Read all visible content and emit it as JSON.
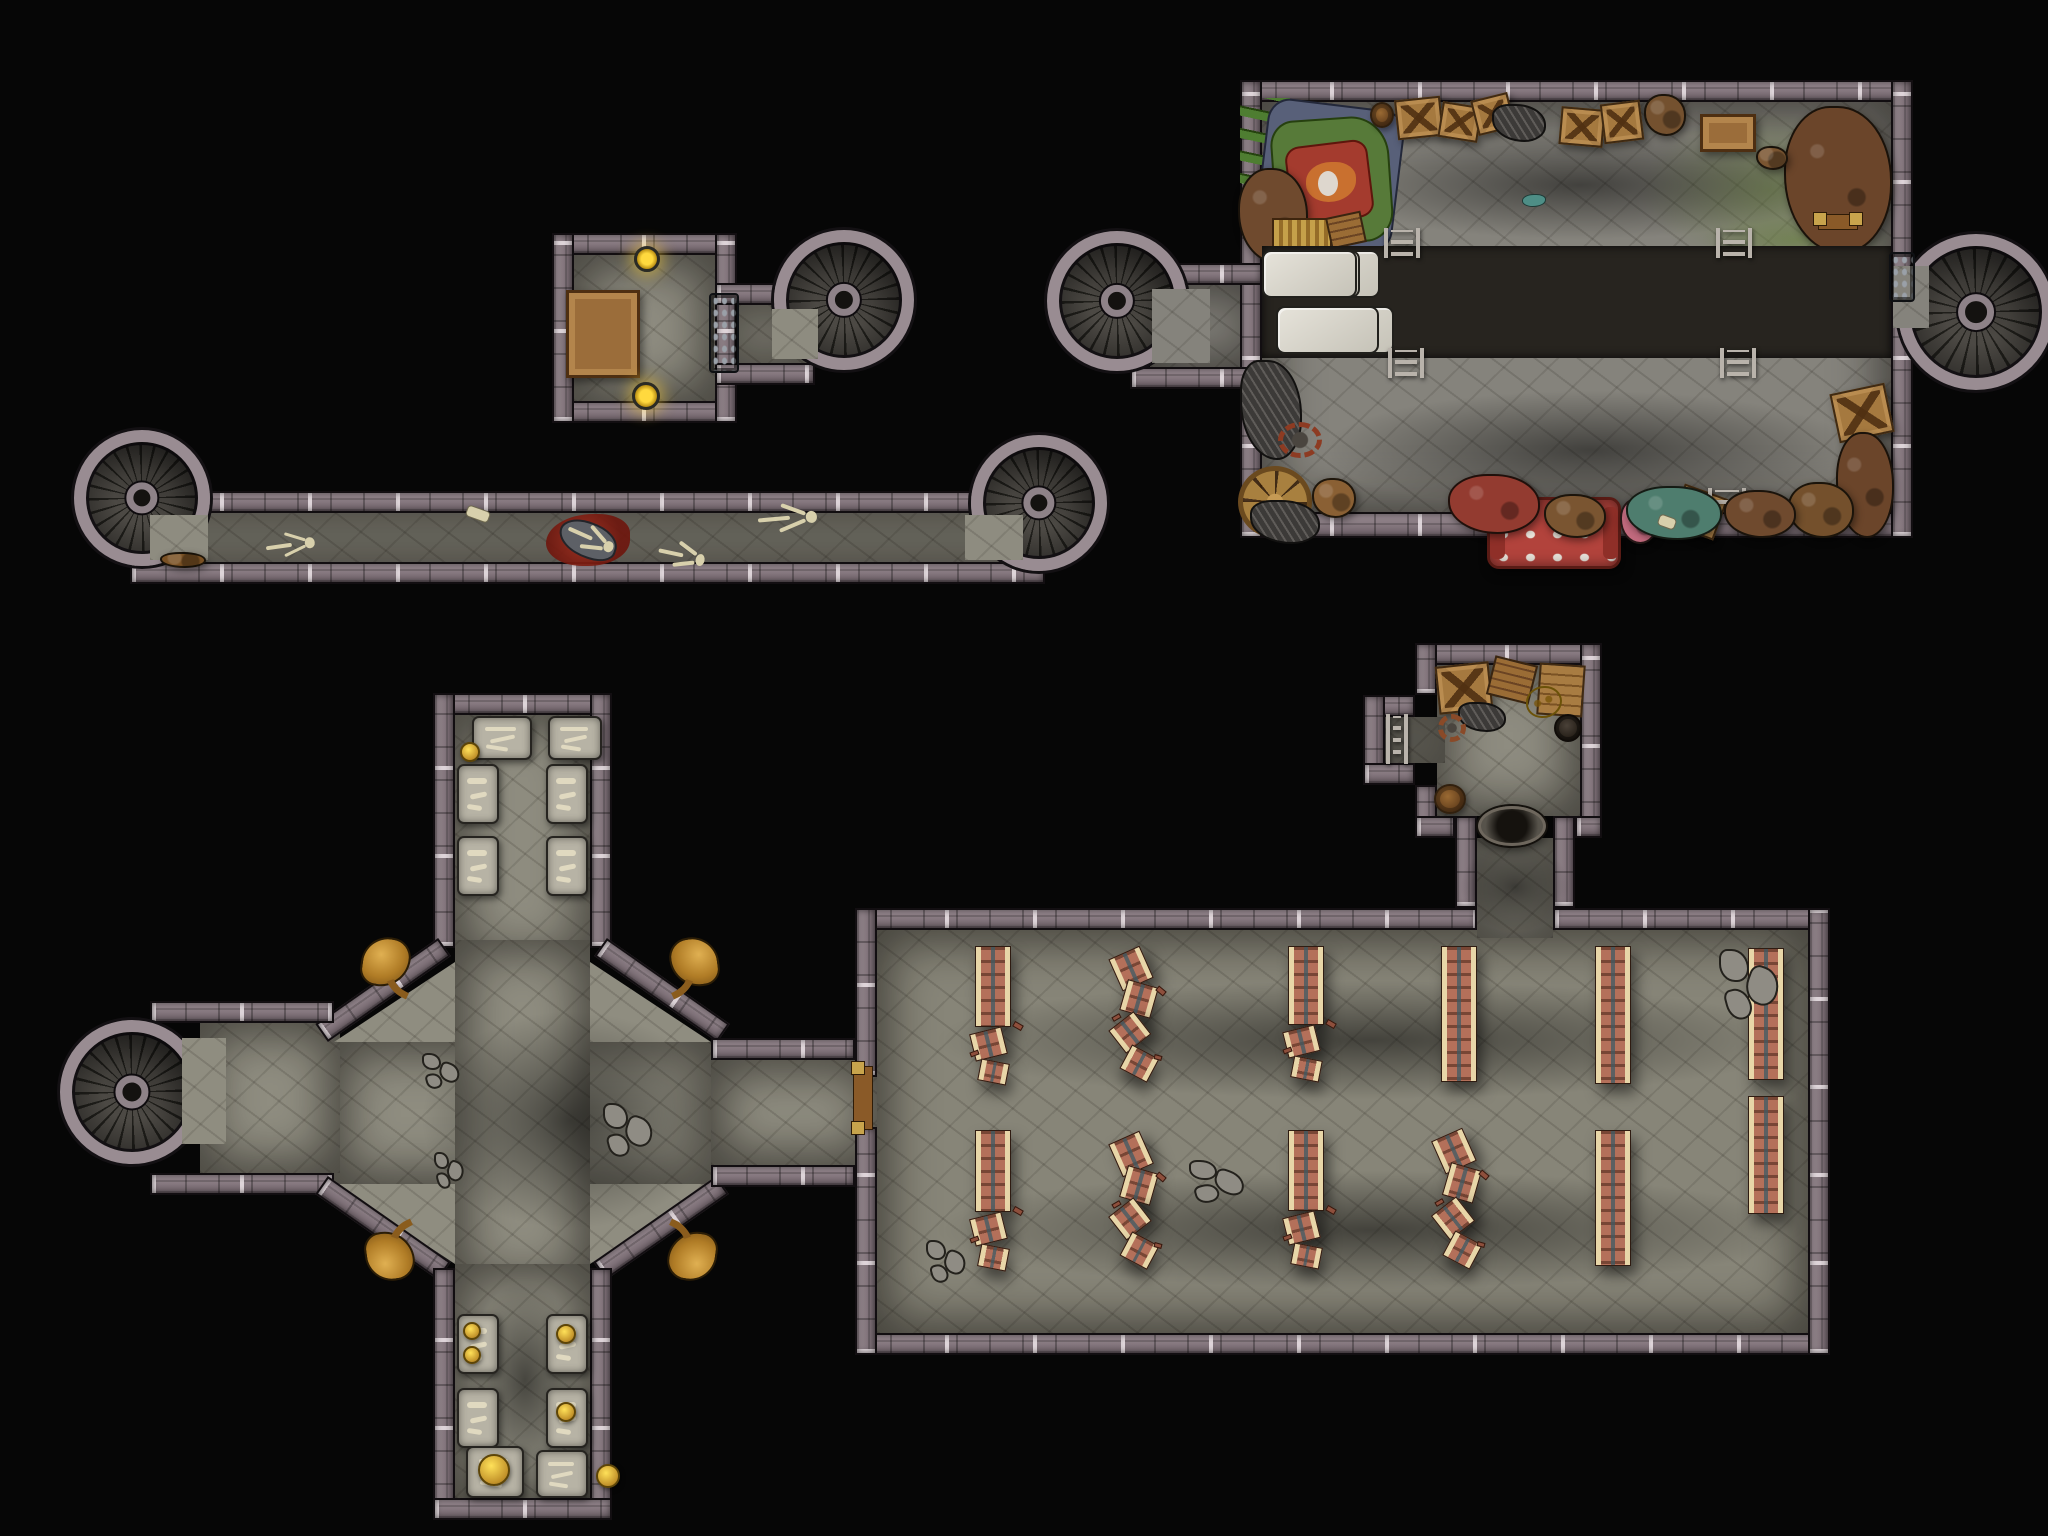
{
  "title": "Top-down dungeon battle map: crypt, chapel hall, storage room and connecting corridors with six spiral staircases",
  "canvas": {
    "w": 2048,
    "h": 1536,
    "bg": "#060606"
  },
  "palette": {
    "background": "#060606",
    "wall": "#80727a",
    "wall_light": "#d6cdd2",
    "wall_dark": "#120e11",
    "floor": "#8e8c80",
    "stair_step": "#4c4944",
    "stair_ring": "#998c92",
    "block_band": "#d6d3c9",
    "bench_wood": "#b4705a",
    "bench_rail": "#e8d6a8",
    "statue_gold": "#c08b33",
    "gold": "#e3c12c",
    "blood": "#8c1f12",
    "rug_green": "#577a39",
    "rug_red": "#a43b2e",
    "moss": "#687f3e",
    "sofa_red": "#b2433c"
  },
  "floors": [
    {
      "x": 574,
      "y": 255,
      "w": 141,
      "h": 146,
      "v": "a"
    },
    {
      "x": 715,
      "y": 305,
      "w": 100,
      "h": 58,
      "v": "a"
    },
    {
      "x": 140,
      "y": 513,
      "w": 905,
      "h": 49,
      "v": "a"
    },
    {
      "x": 1262,
      "y": 102,
      "w": 629,
      "h": 410,
      "v": "b"
    },
    {
      "x": 1150,
      "y": 285,
      "w": 112,
      "h": 82,
      "v": "b"
    },
    {
      "x": 1891,
      "y": 262,
      "w": 40,
      "h": 70,
      "v": "b"
    },
    {
      "x": 455,
      "y": 715,
      "w": 135,
      "h": 250,
      "v": "c"
    },
    {
      "x": 334,
      "y": 1042,
      "w": 377,
      "h": 142,
      "v": "c"
    },
    {
      "x": 455,
      "y": 940,
      "w": 135,
      "h": 350,
      "v": "c"
    },
    {
      "x": 200,
      "y": 1023,
      "w": 140,
      "h": 150,
      "v": "c"
    },
    {
      "x": 711,
      "y": 1060,
      "w": 166,
      "h": 105,
      "v": "c"
    },
    {
      "x": 455,
      "y": 1264,
      "w": 135,
      "h": 234,
      "v": "c"
    },
    {
      "x": 877,
      "y": 930,
      "w": 931,
      "h": 403,
      "v": "d"
    },
    {
      "x": 1437,
      "y": 665,
      "w": 143,
      "h": 151,
      "v": "a"
    },
    {
      "x": 1385,
      "y": 717,
      "w": 60,
      "h": 46,
      "v": "a"
    },
    {
      "x": 1477,
      "y": 838,
      "w": 76,
      "h": 100,
      "v": "a"
    }
  ],
  "floor_polys": [
    {
      "v": "c",
      "points": [
        [
          455,
          962
        ],
        [
          455,
          1042
        ],
        [
          334,
          1042
        ]
      ]
    },
    {
      "v": "c",
      "points": [
        [
          590,
          962
        ],
        [
          711,
          1042
        ],
        [
          590,
          1042
        ]
      ]
    },
    {
      "v": "c",
      "points": [
        [
          334,
          1184
        ],
        [
          455,
          1184
        ],
        [
          455,
          1264
        ]
      ]
    },
    {
      "v": "c",
      "points": [
        [
          711,
          1184
        ],
        [
          590,
          1184
        ],
        [
          590,
          1264
        ]
      ]
    }
  ],
  "walls": [
    {
      "x": 552,
      "y": 233,
      "w": 185,
      "h": 22
    },
    {
      "x": 552,
      "y": 401,
      "w": 185,
      "h": 22
    },
    {
      "x": 552,
      "y": 233,
      "w": 22,
      "h": 190
    },
    {
      "x": 715,
      "y": 233,
      "w": 22,
      "h": 190
    },
    {
      "x": 715,
      "y": 283,
      "w": 100,
      "h": 22
    },
    {
      "x": 715,
      "y": 363,
      "w": 100,
      "h": 22
    },
    {
      "x": 130,
      "y": 491,
      "w": 915,
      "h": 22
    },
    {
      "x": 130,
      "y": 562,
      "w": 915,
      "h": 22
    },
    {
      "x": 1240,
      "y": 80,
      "w": 673,
      "h": 22
    },
    {
      "x": 1240,
      "y": 512,
      "w": 673,
      "h": 26
    },
    {
      "x": 1240,
      "y": 80,
      "w": 22,
      "h": 458
    },
    {
      "x": 1891,
      "y": 80,
      "w": 22,
      "h": 458
    },
    {
      "x": 1130,
      "y": 263,
      "w": 132,
      "h": 22
    },
    {
      "x": 1130,
      "y": 367,
      "w": 132,
      "h": 22
    },
    {
      "x": 433,
      "y": 693,
      "w": 179,
      "h": 22
    },
    {
      "x": 433,
      "y": 693,
      "w": 22,
      "h": 255
    },
    {
      "x": 590,
      "y": 693,
      "w": 22,
      "h": 255
    },
    {
      "x": 308,
      "y": 979,
      "w": 150,
      "h": 22,
      "rot": -35
    },
    {
      "x": 587,
      "y": 979,
      "w": 150,
      "h": 22,
      "rot": 35
    },
    {
      "x": 150,
      "y": 1001,
      "w": 184,
      "h": 22
    },
    {
      "x": 150,
      "y": 1173,
      "w": 184,
      "h": 22
    },
    {
      "x": 308,
      "y": 1217,
      "w": 150,
      "h": 22,
      "rot": 35
    },
    {
      "x": 586,
      "y": 1217,
      "w": 150,
      "h": 22,
      "rot": -35
    },
    {
      "x": 711,
      "y": 1038,
      "w": 144,
      "h": 22
    },
    {
      "x": 711,
      "y": 1165,
      "w": 144,
      "h": 22
    },
    {
      "x": 433,
      "y": 1268,
      "w": 22,
      "h": 252
    },
    {
      "x": 590,
      "y": 1268,
      "w": 22,
      "h": 252
    },
    {
      "x": 433,
      "y": 1498,
      "w": 179,
      "h": 22
    },
    {
      "x": 855,
      "y": 908,
      "w": 622,
      "h": 22
    },
    {
      "x": 1553,
      "y": 908,
      "w": 277,
      "h": 22
    },
    {
      "x": 855,
      "y": 1333,
      "w": 975,
      "h": 22
    },
    {
      "x": 855,
      "y": 908,
      "w": 22,
      "h": 169
    },
    {
      "x": 855,
      "y": 1127,
      "w": 22,
      "h": 228
    },
    {
      "x": 1808,
      "y": 908,
      "w": 22,
      "h": 447
    },
    {
      "x": 1415,
      "y": 643,
      "w": 187,
      "h": 22
    },
    {
      "x": 1415,
      "y": 643,
      "w": 22,
      "h": 52
    },
    {
      "x": 1415,
      "y": 785,
      "w": 22,
      "h": 53
    },
    {
      "x": 1363,
      "y": 695,
      "w": 52,
      "h": 22
    },
    {
      "x": 1363,
      "y": 695,
      "w": 22,
      "h": 90
    },
    {
      "x": 1363,
      "y": 763,
      "w": 52,
      "h": 22
    },
    {
      "x": 1580,
      "y": 643,
      "w": 22,
      "h": 195
    },
    {
      "x": 1415,
      "y": 816,
      "w": 40,
      "h": 22
    },
    {
      "x": 1575,
      "y": 816,
      "w": 27,
      "h": 22
    },
    {
      "x": 1455,
      "y": 816,
      "w": 22,
      "h": 92
    },
    {
      "x": 1553,
      "y": 816,
      "w": 22,
      "h": 92
    }
  ],
  "stairs": [
    {
      "name": "nw-room-stair",
      "cx": 844,
      "cy": 300,
      "r": 70
    },
    {
      "name": "west-corridor-left-stair",
      "cx": 142,
      "cy": 498,
      "r": 68
    },
    {
      "name": "west-corridor-right-stair",
      "cx": 1039,
      "cy": 503,
      "r": 68
    },
    {
      "name": "storage-left-stair",
      "cx": 1117,
      "cy": 301,
      "r": 70
    },
    {
      "name": "storage-right-stair",
      "cx": 1976,
      "cy": 312,
      "r": 78
    },
    {
      "name": "crypt-west-stair",
      "cx": 132,
      "cy": 1092,
      "r": 72
    }
  ],
  "overfloors": [
    {
      "x": 772,
      "y": 309,
      "w": 46,
      "h": 50,
      "v": "a"
    },
    {
      "x": 150,
      "y": 515,
      "w": 58,
      "h": 45,
      "v": "a"
    },
    {
      "x": 965,
      "y": 515,
      "w": 58,
      "h": 45,
      "v": "a"
    },
    {
      "x": 1152,
      "y": 289,
      "w": 58,
      "h": 74,
      "v": "b"
    },
    {
      "x": 1893,
      "y": 266,
      "w": 36,
      "h": 62,
      "v": "b"
    },
    {
      "x": 182,
      "y": 1038,
      "w": 44,
      "h": 106,
      "v": "c"
    }
  ],
  "props": [
    {
      "t": "moss",
      "x": 1640,
      "y": 110,
      "w": 260,
      "h": 160
    },
    {
      "t": "moss",
      "x": 1700,
      "y": 215,
      "w": 195,
      "h": 50
    },
    {
      "t": "moss",
      "x": 1262,
      "y": 95,
      "w": 90,
      "h": 120
    },
    {
      "t": "shadow",
      "x": 1320,
      "y": 130,
      "w": 520,
      "h": 110
    },
    {
      "t": "shadow",
      "x": 1320,
      "y": 390,
      "w": 540,
      "h": 120
    },
    {
      "t": "pipes",
      "x": 1240,
      "y": 98,
      "w": 50,
      "h": 130
    },
    {
      "t": "rug",
      "x": 1268,
      "y": 112,
      "w": 125,
      "h": 140
    },
    {
      "t": "junk",
      "x": 1238,
      "y": 168,
      "w": 70,
      "h": 95,
      "c": "#6f4a2e"
    },
    {
      "t": "junk",
      "x": 1784,
      "y": 106,
      "w": 108,
      "h": 148,
      "c": "#6b452a"
    },
    {
      "t": "bed",
      "x": 1272,
      "y": 218,
      "w": 60,
      "h": 30
    },
    {
      "t": "plank",
      "x": 1328,
      "y": 214,
      "w": 36,
      "h": 32,
      "rot": -12
    },
    {
      "t": "barrel",
      "x": 1370,
      "y": 102,
      "w": 24,
      "h": 26
    },
    {
      "t": "crate",
      "x": 1396,
      "y": 98,
      "w": 46,
      "h": 40,
      "rot": -6
    },
    {
      "t": "crate",
      "x": 1440,
      "y": 104,
      "w": 40,
      "h": 36,
      "rot": 9
    },
    {
      "t": "crate",
      "x": 1474,
      "y": 96,
      "w": 38,
      "h": 36,
      "rot": -14
    },
    {
      "t": "scrap",
      "x": 1492,
      "y": 104,
      "w": 54,
      "h": 38
    },
    {
      "t": "crate",
      "x": 1560,
      "y": 108,
      "w": 44,
      "h": 38,
      "rot": 5
    },
    {
      "t": "crate",
      "x": 1602,
      "y": 102,
      "w": 40,
      "h": 40,
      "rot": -7
    },
    {
      "t": "junk",
      "x": 1644,
      "y": 94,
      "w": 42,
      "h": 42,
      "c": "#74512f"
    },
    {
      "t": "table",
      "x": 1700,
      "y": 114,
      "w": 56,
      "h": 38
    },
    {
      "t": "junk",
      "x": 1756,
      "y": 146,
      "w": 32,
      "h": 24,
      "c": "#7a5531"
    },
    {
      "t": "bar",
      "x": 1818,
      "y": 214,
      "w": 40,
      "h": 16
    },
    {
      "t": "teal",
      "x": 1522,
      "y": 194,
      "w": 24,
      "h": 13
    },
    {
      "t": "band",
      "x": 1262,
      "y": 246,
      "w": 629,
      "h": 112,
      "rows": [
        [
          112,
          104,
          118,
          98,
          92,
          95
        ],
        [
          86,
          112,
          104,
          118,
          96,
          103
        ]
      ]
    },
    {
      "t": "ladder",
      "x": 1384,
      "y": 228,
      "w": 36,
      "h": 30
    },
    {
      "t": "ladder",
      "x": 1716,
      "y": 228,
      "w": 36,
      "h": 30
    },
    {
      "t": "ladder",
      "x": 1388,
      "y": 348,
      "w": 36,
      "h": 30
    },
    {
      "t": "ladder",
      "x": 1720,
      "y": 348,
      "w": 36,
      "h": 30
    },
    {
      "t": "scrap",
      "x": 1240,
      "y": 360,
      "w": 62,
      "h": 100
    },
    {
      "t": "gear",
      "x": 1278,
      "y": 422,
      "w": 44,
      "h": 36,
      "c": "#8d3b22"
    },
    {
      "t": "wheel",
      "x": 1238,
      "y": 466,
      "w": 74,
      "h": 72
    },
    {
      "t": "junk",
      "x": 1312,
      "y": 478,
      "w": 44,
      "h": 40,
      "c": "#8a6034"
    },
    {
      "t": "scrap",
      "x": 1250,
      "y": 500,
      "w": 70,
      "h": 44
    },
    {
      "t": "sofa",
      "x": 1487,
      "y": 497,
      "w": 134,
      "h": 72
    },
    {
      "t": "junk",
      "x": 1620,
      "y": 498,
      "w": 38,
      "h": 46,
      "c": "#c26a7e"
    },
    {
      "t": "crate",
      "x": 1676,
      "y": 490,
      "w": 46,
      "h": 44,
      "rot": 20
    },
    {
      "t": "ladder",
      "x": 1708,
      "y": 488,
      "w": 38,
      "h": 26
    },
    {
      "t": "crate",
      "x": 1834,
      "y": 388,
      "w": 56,
      "h": 50,
      "rot": -12
    },
    {
      "t": "junk",
      "x": 1836,
      "y": 432,
      "w": 58,
      "h": 106,
      "c": "#6b452a"
    },
    {
      "t": "junk",
      "x": 1788,
      "y": 482,
      "w": 66,
      "h": 56,
      "c": "#74502c"
    },
    {
      "t": "junk",
      "x": 1448,
      "y": 474,
      "w": 92,
      "h": 60,
      "c": "#933b30"
    },
    {
      "t": "junk",
      "x": 1544,
      "y": 494,
      "w": 62,
      "h": 44,
      "c": "#7a5531"
    },
    {
      "t": "junk",
      "x": 1626,
      "y": 486,
      "w": 96,
      "h": 54,
      "c": "#4e7d6e"
    },
    {
      "t": "junk",
      "x": 1724,
      "y": 490,
      "w": 72,
      "h": 48,
      "c": "#6f4a2e"
    },
    {
      "t": "bonebit",
      "x": 1658,
      "y": 516,
      "w": 18,
      "h": 12
    },
    {
      "t": "door",
      "x": 1889,
      "y": 252,
      "w": 26,
      "h": 50
    },
    {
      "t": "table",
      "x": 566,
      "y": 290,
      "w": 74,
      "h": 88
    },
    {
      "t": "sconce",
      "x": 634,
      "y": 246,
      "w": 26,
      "h": 26
    },
    {
      "t": "sconce",
      "x": 632,
      "y": 382,
      "w": 28,
      "h": 28
    },
    {
      "t": "door",
      "x": 709,
      "y": 293,
      "w": 30,
      "h": 80
    },
    {
      "t": "junk",
      "x": 160,
      "y": 552,
      "w": 46,
      "h": 16,
      "c": "#7a5124"
    },
    {
      "t": "skel",
      "x": 266,
      "y": 532,
      "w": 48,
      "h": 28,
      "rot": -8
    },
    {
      "t": "blood",
      "x": 546,
      "y": 514,
      "w": 84,
      "h": 52
    },
    {
      "t": "corpse",
      "x": 558,
      "y": 522,
      "w": 60,
      "h": 36,
      "rot": 18
    },
    {
      "t": "skel",
      "x": 566,
      "y": 524,
      "w": 48,
      "h": 30,
      "rot": 24
    },
    {
      "t": "skel",
      "x": 658,
      "y": 540,
      "w": 46,
      "h": 32,
      "rot": 12
    },
    {
      "t": "skel",
      "x": 758,
      "y": 503,
      "w": 58,
      "h": 32,
      "rot": -5
    },
    {
      "t": "bonebit",
      "x": 466,
      "y": 508,
      "w": 24,
      "h": 12
    },
    {
      "t": "slab",
      "x": 472,
      "y": 716,
      "w": 60,
      "h": 44
    },
    {
      "t": "slab",
      "x": 548,
      "y": 716,
      "w": 54,
      "h": 44
    },
    {
      "t": "gold",
      "x": 460,
      "y": 742,
      "w": 20,
      "h": 20
    },
    {
      "t": "slab",
      "x": 457,
      "y": 764,
      "w": 42,
      "h": 60
    },
    {
      "t": "slab",
      "x": 457,
      "y": 836,
      "w": 42,
      "h": 60
    },
    {
      "t": "slab",
      "x": 546,
      "y": 764,
      "w": 42,
      "h": 60
    },
    {
      "t": "slab",
      "x": 546,
      "y": 836,
      "w": 42,
      "h": 60
    },
    {
      "t": "statue",
      "x": 356,
      "y": 932,
      "w": 60,
      "h": 62,
      "fx": 1,
      "fy": 1
    },
    {
      "t": "statue",
      "x": 664,
      "y": 932,
      "w": 60,
      "h": 62,
      "fx": -1,
      "fy": 1
    },
    {
      "t": "statue",
      "x": 360,
      "y": 1224,
      "w": 60,
      "h": 62,
      "fx": 1,
      "fy": -1
    },
    {
      "t": "statue",
      "x": 662,
      "y": 1224,
      "w": 60,
      "h": 62,
      "fx": -1,
      "fy": -1
    },
    {
      "t": "shadow",
      "x": 420,
      "y": 1010,
      "w": 300,
      "h": 220
    },
    {
      "t": "shadow",
      "x": 470,
      "y": 1280,
      "w": 110,
      "h": 200
    },
    {
      "t": "rubble",
      "x": 420,
      "y": 1050,
      "w": 42,
      "h": 42
    },
    {
      "t": "rubble",
      "x": 600,
      "y": 1098,
      "w": 56,
      "h": 64
    },
    {
      "t": "rubble",
      "x": 432,
      "y": 1148,
      "w": 34,
      "h": 44
    },
    {
      "t": "slab",
      "x": 457,
      "y": 1314,
      "w": 42,
      "h": 60
    },
    {
      "t": "gold",
      "x": 463,
      "y": 1322,
      "w": 18,
      "h": 18
    },
    {
      "t": "gold",
      "x": 463,
      "y": 1346,
      "w": 18,
      "h": 18
    },
    {
      "t": "slab",
      "x": 457,
      "y": 1388,
      "w": 42,
      "h": 60
    },
    {
      "t": "slab",
      "x": 546,
      "y": 1314,
      "w": 42,
      "h": 60
    },
    {
      "t": "gold",
      "x": 556,
      "y": 1324,
      "w": 20,
      "h": 20
    },
    {
      "t": "slab",
      "x": 546,
      "y": 1388,
      "w": 42,
      "h": 60
    },
    {
      "t": "gold",
      "x": 596,
      "y": 1464,
      "w": 24,
      "h": 24
    },
    {
      "t": "slab",
      "x": 466,
      "y": 1446,
      "w": 58,
      "h": 52
    },
    {
      "t": "gold",
      "x": 478,
      "y": 1454,
      "w": 32,
      "h": 32
    },
    {
      "t": "slab",
      "x": 536,
      "y": 1450,
      "w": 52,
      "h": 48
    },
    {
      "t": "gold",
      "x": 556,
      "y": 1402,
      "w": 20,
      "h": 20
    },
    {
      "t": "bar",
      "x": 853,
      "y": 1066,
      "w": 20,
      "h": 64
    },
    {
      "t": "shadow",
      "x": 930,
      "y": 980,
      "w": 880,
      "h": 120
    },
    {
      "t": "shadow",
      "x": 930,
      "y": 1170,
      "w": 880,
      "h": 120
    },
    {
      "t": "bench",
      "x": 975,
      "y": 946,
      "w": 36,
      "h": 140,
      "s": "b"
    },
    {
      "t": "bench",
      "x": 1118,
      "y": 948,
      "w": 36,
      "h": 134,
      "s": "d"
    },
    {
      "t": "bench",
      "x": 1288,
      "y": 946,
      "w": 36,
      "h": 136,
      "s": "b"
    },
    {
      "t": "bench",
      "x": 1441,
      "y": 946,
      "w": 36,
      "h": 136,
      "s": "i"
    },
    {
      "t": "bench",
      "x": 1595,
      "y": 946,
      "w": 36,
      "h": 138,
      "s": "i"
    },
    {
      "t": "bench",
      "x": 1748,
      "y": 948,
      "w": 36,
      "h": 132,
      "s": "i"
    },
    {
      "t": "bench",
      "x": 975,
      "y": 1130,
      "w": 36,
      "h": 142,
      "s": "b"
    },
    {
      "t": "bench",
      "x": 1118,
      "y": 1133,
      "w": 36,
      "h": 137,
      "s": "d"
    },
    {
      "t": "bench",
      "x": 1288,
      "y": 1130,
      "w": 36,
      "h": 140,
      "s": "b"
    },
    {
      "t": "bench",
      "x": 1441,
      "y": 1130,
      "w": 36,
      "h": 140,
      "s": "d"
    },
    {
      "t": "bench",
      "x": 1595,
      "y": 1130,
      "w": 36,
      "h": 136,
      "s": "i"
    },
    {
      "t": "bench",
      "x": 1748,
      "y": 1096,
      "w": 36,
      "h": 118,
      "s": "i"
    },
    {
      "t": "rubble",
      "x": 1716,
      "y": 942,
      "w": 66,
      "h": 84
    },
    {
      "t": "rubble",
      "x": 1186,
      "y": 1156,
      "w": 62,
      "h": 50
    },
    {
      "t": "rubble",
      "x": 924,
      "y": 1236,
      "w": 44,
      "h": 50
    },
    {
      "t": "crate",
      "x": 1437,
      "y": 664,
      "w": 54,
      "h": 48,
      "rot": -6
    },
    {
      "t": "plank",
      "x": 1490,
      "y": 660,
      "w": 44,
      "h": 40,
      "rot": 14
    },
    {
      "t": "scrap",
      "x": 1458,
      "y": 702,
      "w": 48,
      "h": 30
    },
    {
      "t": "gear",
      "x": 1438,
      "y": 714,
      "w": 28,
      "h": 28,
      "c": "#8a4a28"
    },
    {
      "t": "pallet",
      "x": 1538,
      "y": 664,
      "w": 46,
      "h": 52,
      "rot": 4
    },
    {
      "t": "goldpile",
      "x": 1526,
      "y": 686,
      "w": 36,
      "h": 32
    },
    {
      "t": "pot",
      "x": 1554,
      "y": 714,
      "w": 28,
      "h": 28
    },
    {
      "t": "barrel",
      "x": 1434,
      "y": 784,
      "w": 32,
      "h": 30
    },
    {
      "t": "ladder",
      "x": 1386,
      "y": 714,
      "w": 22,
      "h": 50
    },
    {
      "t": "basin",
      "x": 1478,
      "y": 806,
      "w": 68,
      "h": 40
    },
    {
      "t": "shadow",
      "x": 1460,
      "y": 842,
      "w": 110,
      "h": 90
    }
  ]
}
